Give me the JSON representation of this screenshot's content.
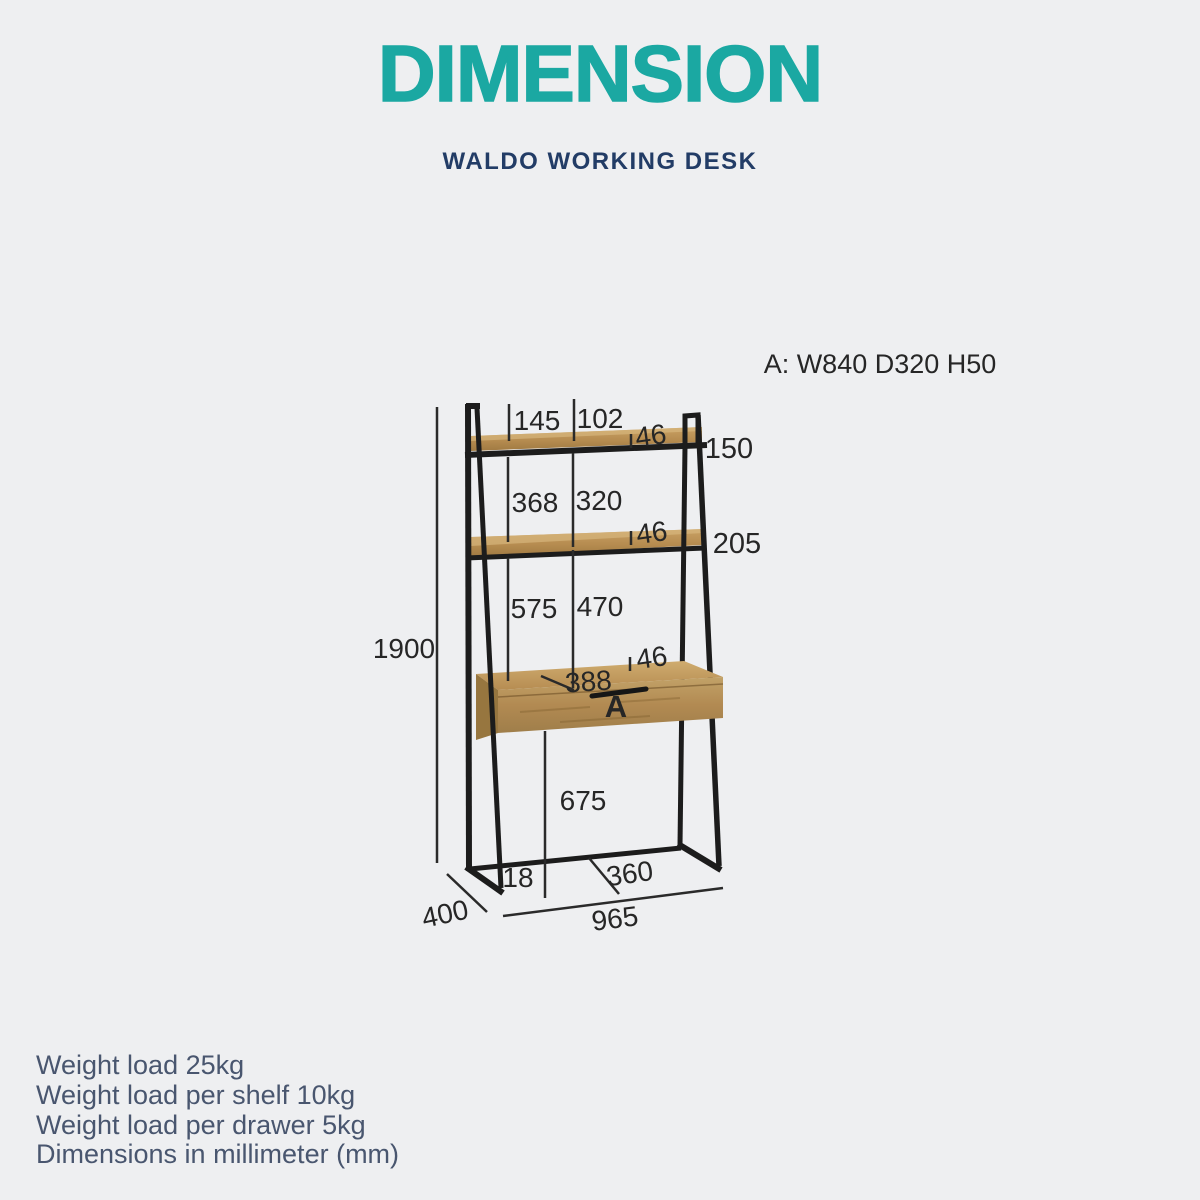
{
  "header": {
    "title": "DIMENSION",
    "title_color": "#1BA8A2",
    "subtitle": "WALDO WORKING DESK",
    "subtitle_color": "#223C66"
  },
  "diagram": {
    "spec_label": "A: W840 D320 H50",
    "drawer_label": "A",
    "colors": {
      "frame": "#1C1C1C",
      "wood": "#B8915A",
      "dimension_text": "#262626",
      "background": "#EEEFF1"
    },
    "dimensions": {
      "top_offset_left": "145",
      "top_offset_right": "102",
      "top_shelf_thickness": "46",
      "top_frame_height": "150",
      "upper_gap_left": "368",
      "upper_gap_right": "320",
      "middle_shelf_thickness": "46",
      "middle_frame_height": "205",
      "lower_gap_left": "575",
      "lower_gap_right": "470",
      "desk_top_thickness": "46",
      "drawer_inner_width": "388",
      "under_desk_clearance": "675",
      "overall_height": "1900",
      "foot_inset": "18",
      "base_depth_inner": "360",
      "overall_depth": "400",
      "overall_width": "965"
    }
  },
  "notes": {
    "lines": [
      "Weight load 25kg",
      "Weight load per shelf 10kg",
      "Weight load per drawer 5kg",
      "Dimensions in millimeter (mm)"
    ]
  }
}
